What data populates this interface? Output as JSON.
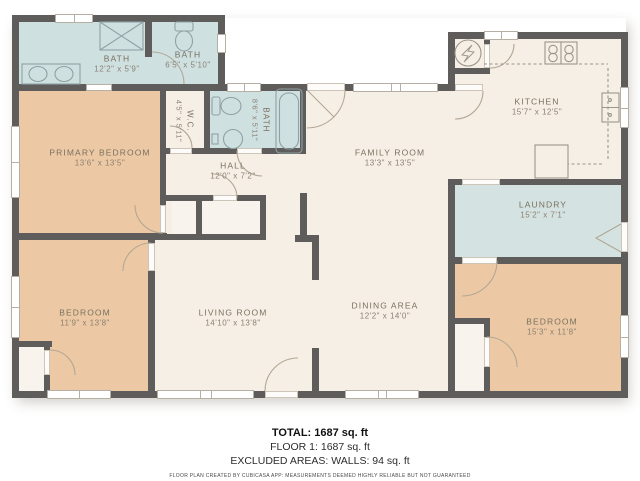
{
  "rooms": {
    "bath_main": {
      "name": "BATH",
      "dims": "12'2\" x 5'9\""
    },
    "bath_hall": {
      "name": "BATH",
      "dims": "6'5\" x 5'10\""
    },
    "wc": {
      "name": "W.C.",
      "dims": "4'5\" x 5'11\""
    },
    "bath_ensuite": {
      "name": "BATH",
      "dims": "8'6\" x 5'11\""
    },
    "primary_bedroom": {
      "name": "PRIMARY BEDROOM",
      "dims": "13'6\" x 13'5\""
    },
    "hall": {
      "name": "HALL",
      "dims": "12'0\" x 7'2\""
    },
    "family_room": {
      "name": "FAMILY ROOM",
      "dims": "13'3\" x 13'5\""
    },
    "kitchen": {
      "name": "KITCHEN",
      "dims": "15'7\" x 12'5\""
    },
    "laundry": {
      "name": "LAUNDRY",
      "dims": "15'2\" x 7'1\""
    },
    "bedroom_left": {
      "name": "BEDROOM",
      "dims": "11'9\" x 13'8\""
    },
    "living_room": {
      "name": "LIVING ROOM",
      "dims": "14'10\" x 13'8\""
    },
    "dining_area": {
      "name": "DINING AREA",
      "dims": "12'2\" x 14'0\""
    },
    "bedroom_right": {
      "name": "BEDROOM",
      "dims": "15'3\" x 11'8\""
    }
  },
  "footer": {
    "total": "TOTAL: 1687 sq. ft",
    "floor1": "FLOOR 1: 1687 sq. ft",
    "excluded": "EXCLUDED AREAS: WALLS: 94 sq. ft",
    "disclaimer": "FLOOR PLAN CREATED BY CUBICASA APP: MEASUREMENTS DEEMED HIGHLY RELIABLE BUT NOT GUARANTEED"
  },
  "colors": {
    "wall": "#5e5d5c",
    "floor_cream": "#f6efe6",
    "floor_bedroom_tan": "#ecc9a4",
    "floor_bath_blue": "#cfe0e1",
    "floor_laundry_blue": "#d4e2e1",
    "label_text": "#79705f"
  }
}
